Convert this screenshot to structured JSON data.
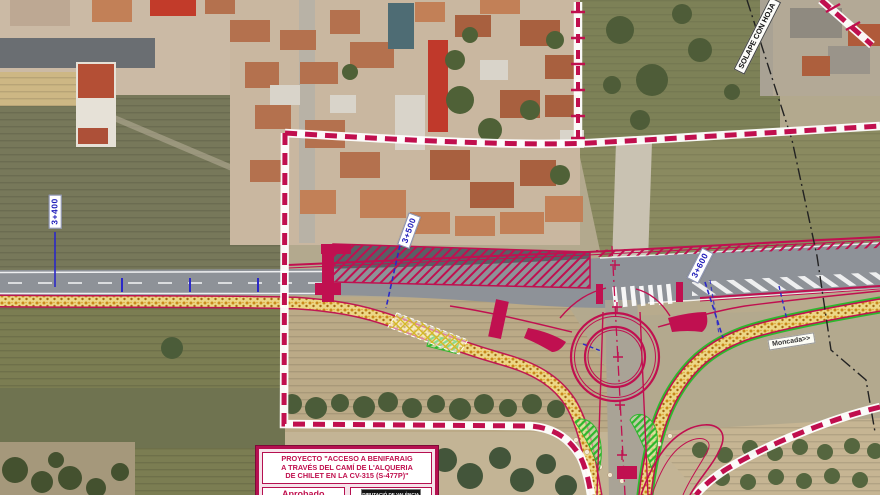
{
  "map": {
    "stations": [
      {
        "text": "3+400"
      },
      {
        "text": "3+500"
      },
      {
        "text": "3+600"
      }
    ],
    "overlap_note": "SOLAPE CON HOJA",
    "direction_label": "Moncada>>"
  },
  "title_block": {
    "title_line1": "PROYECTO \"ACCESO A BENIFARAIG",
    "title_line2": "A TRAVÉS DEL CAMÍ DE L'ALQUERIA",
    "title_line3": "DE CHILET EN LA CV-315 (S-477P)\"",
    "approval": "Aprobado",
    "logo": "DIPUTACIÓ DE VALÈNCIA"
  },
  "colors": {
    "project_boundary": "#c00f4e",
    "cad_line": "#c01050",
    "station_blue": "#2a28c8",
    "embankment_dots": "#c8891c",
    "greenery_hatch": "#2eb82e",
    "road_gray": "#8e9298"
  }
}
